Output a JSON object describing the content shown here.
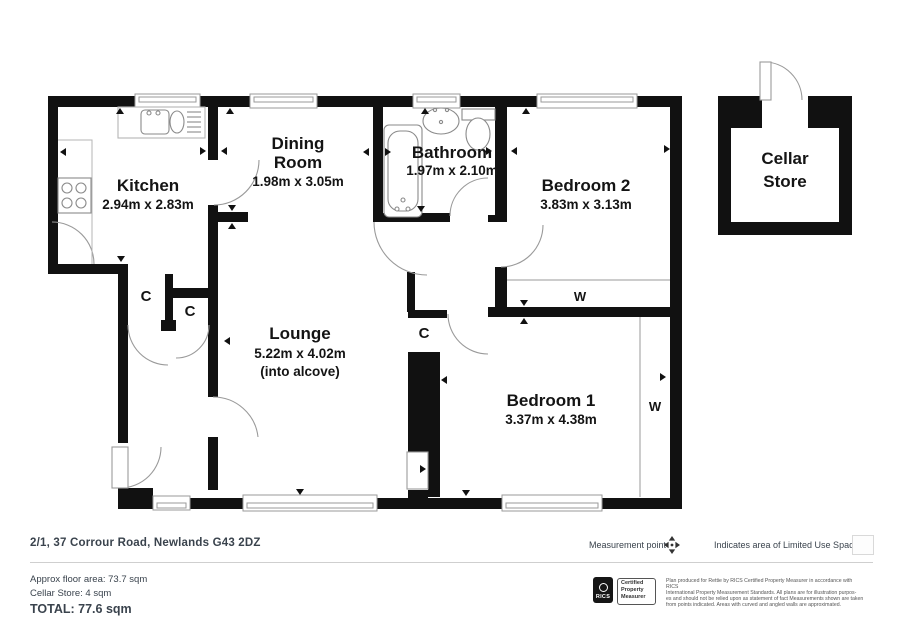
{
  "plan": {
    "rooms": {
      "kitchen": {
        "name": "Kitchen",
        "dims": "2.94m x 2.83m"
      },
      "dining": {
        "name_line1": "Dining",
        "name_line2": "Room",
        "dims": "1.98m x 3.05m"
      },
      "bathroom": {
        "name": "Bathroom",
        "dims": "1.97m x 2.10m"
      },
      "bedroom2": {
        "name": "Bedroom 2",
        "dims": "3.83m x 3.13m"
      },
      "lounge": {
        "name": "Lounge",
        "dims": "5.22m x 4.02m",
        "note": "(into alcove)"
      },
      "bedroom1": {
        "name": "Bedroom 1",
        "dims": "3.37m x 4.38m"
      },
      "cellar": {
        "name_line1": "Cellar",
        "name_line2": "Store"
      }
    },
    "labels": {
      "closet": "C",
      "wardrobe": "W"
    },
    "colors": {
      "wall": "#111111",
      "door_arc": "#9a9a9a",
      "text": "#141414"
    }
  },
  "footer": {
    "address": "2/1, 37 Corrour Road, Newlands G43 2DZ",
    "approx_area": "Approx floor area: 73.7 sqm",
    "cellar_area": "Cellar Store: 4 sqm",
    "total": "TOTAL: 77.6 sqm",
    "legend": {
      "measurement_point": "Measurement point",
      "limited_use": "Indicates area of  Limited Use Space"
    },
    "rics": {
      "abbr": "RICS",
      "cert_line1": "Certified",
      "cert_line2": "Property",
      "cert_line3": "Measurer"
    },
    "disclaimer_line1": "Plan produced for Rettie by RICS Certified Property Measurer in accordance with RICS",
    "disclaimer_line2": "International Property  Measurement Standards.  All plans are for illustration purpos-",
    "disclaimer_line3": "es and should not be relied upon as statement of fact Measurements shown are taken",
    "disclaimer_line4": "from points indicated. Areas with curved and angled walls are approximated."
  }
}
